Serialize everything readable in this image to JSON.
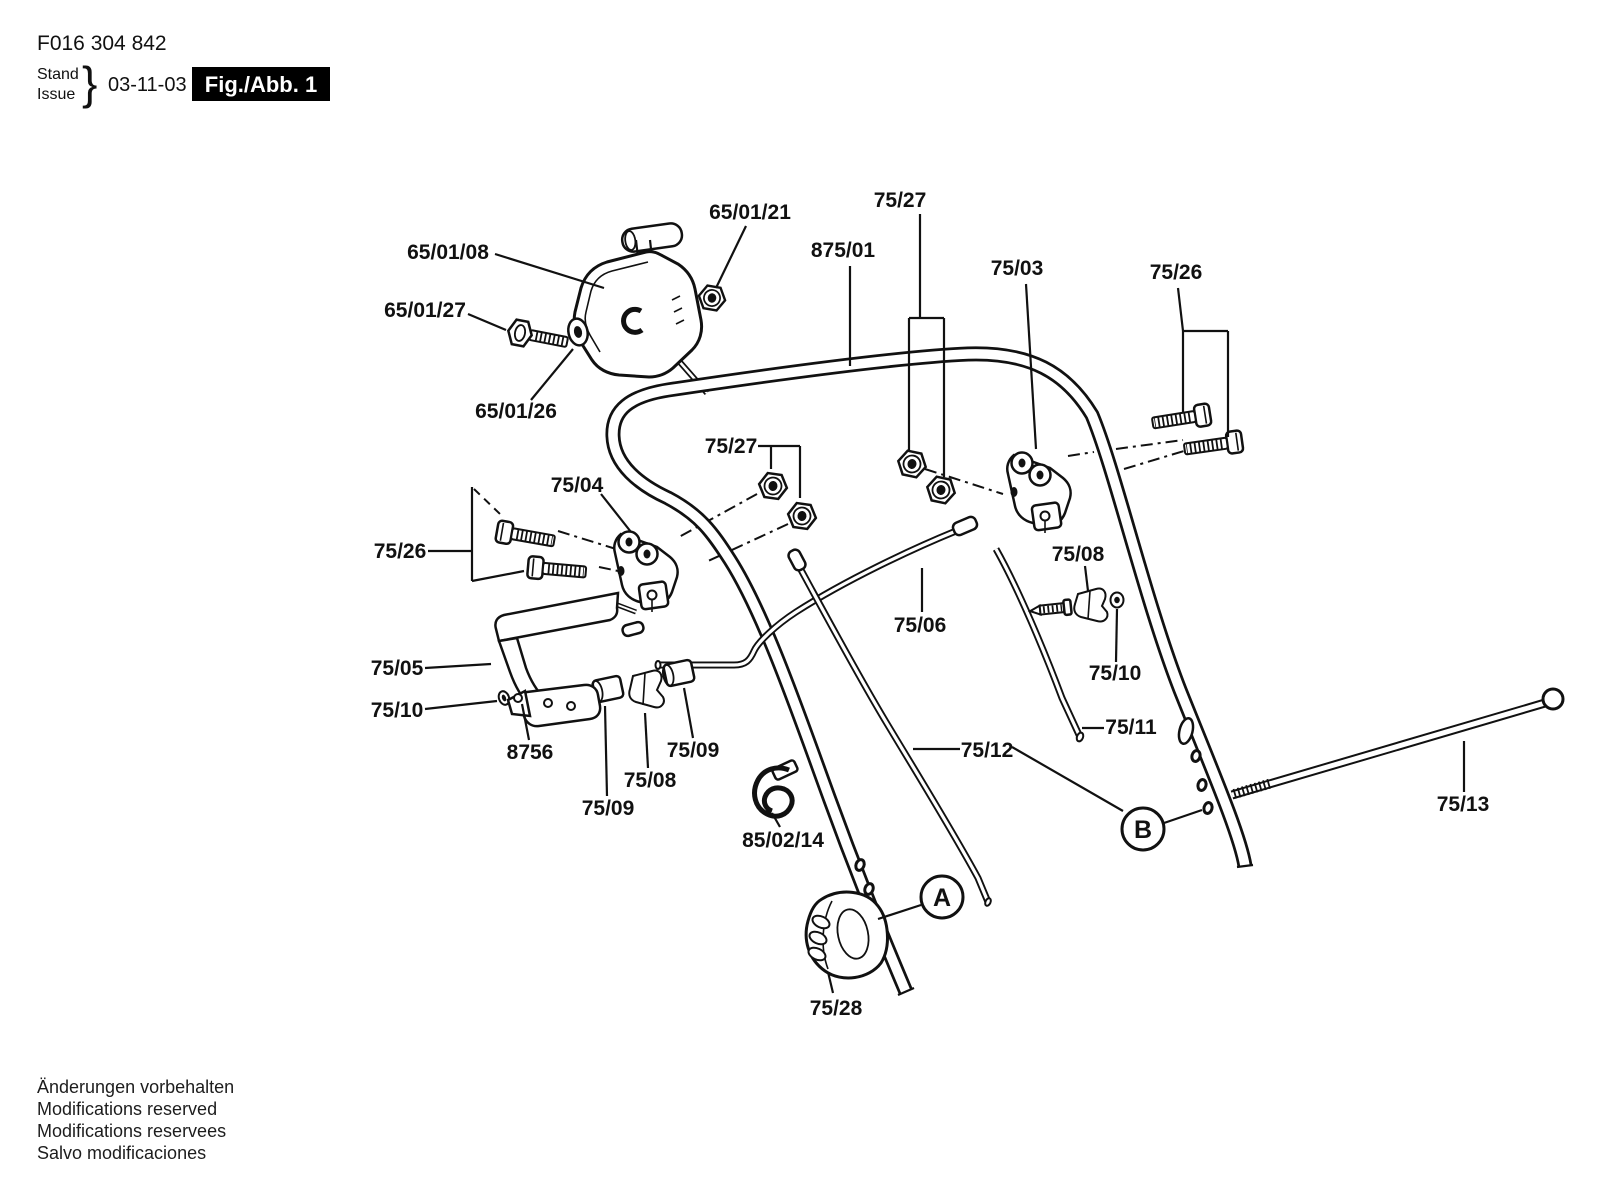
{
  "header": {
    "part_number": "F016 304 842",
    "stand_label": "Stand",
    "issue_label": "Issue",
    "brace": "}",
    "issue_date": "03-11-03",
    "figure_label": "Fig./Abb. 1"
  },
  "footer": {
    "line1": "Änderungen vorbehalten",
    "line2": "Modifications reserved",
    "line3": "Modifications reservees",
    "line4": "Salvo modificaciones"
  },
  "callouts": {
    "switch_housing": "65/01/08",
    "switch_nut": "65/01/21",
    "switch_bolt": "65/01/27",
    "switch_washer": "65/01/26",
    "nuts_top": "75/27",
    "upper_handle": "875/01",
    "clamp_right": "75/03",
    "bolts_right": "75/26",
    "nuts_mid": "75/27",
    "clamp_left": "75/04",
    "bolts_left": "75/26",
    "clip_right": "75/08",
    "cable_upper": "75/06",
    "grommet_right": "75/10",
    "lever": "75/05",
    "cap_left": "75/10",
    "lever_bracket": "8756",
    "bushing_right": "75/09",
    "clip_left": "75/08",
    "bushing_left": "75/09",
    "cable_right": "75/11",
    "cable_long": "75/12",
    "cable_clip": "85/02/14",
    "rod": "75/13",
    "knob": "75/28",
    "detail_a": "A",
    "detail_b": "B"
  }
}
